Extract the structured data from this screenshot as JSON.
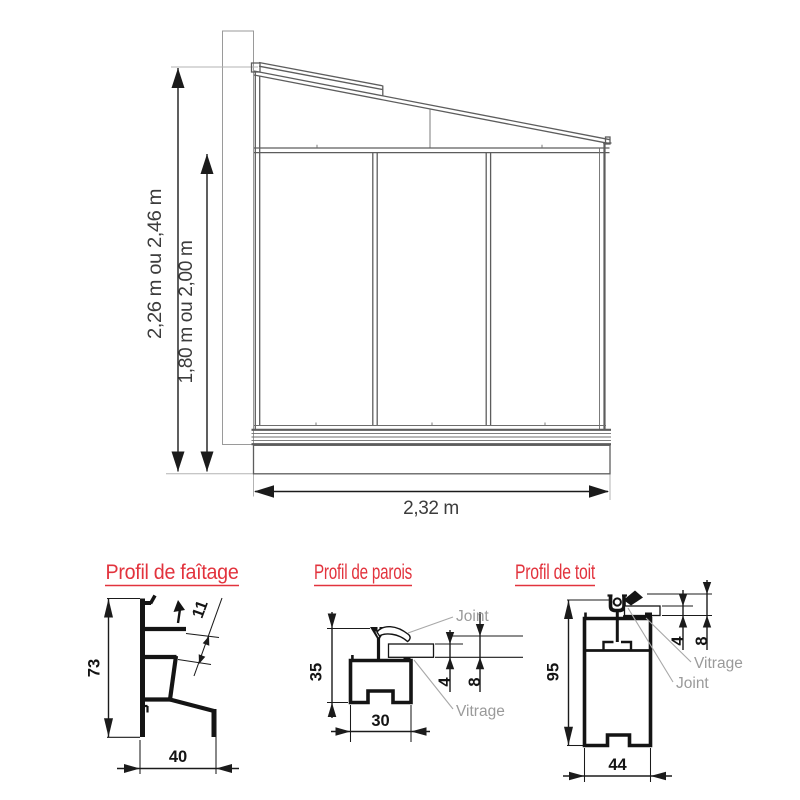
{
  "elevation": {
    "height_total_label": "2,26 m ou 2,46 m",
    "height_wall_label": "1,80 m ou 2,00 m",
    "width_label": "2,32 m"
  },
  "profiles": {
    "faitage": {
      "title": "Profil de faîtage",
      "height_mm": "73",
      "width_mm": "40",
      "glazing_mm": "11"
    },
    "parois": {
      "title": "Profil de parois",
      "height_mm": "35",
      "width_mm": "30",
      "glass_mm": "4",
      "glass_joint_mm": "8",
      "joint_label": "Joint",
      "vitrage_label": "Vitrage"
    },
    "toit": {
      "title": "Profil de toit",
      "height_mm": "95",
      "width_mm": "44",
      "glass_mm": "4",
      "glass_joint_mm": "8",
      "joint_label": "Joint",
      "vitrage_label": "Vitrage"
    }
  },
  "colors": {
    "accent_red": "#e2333d",
    "dimension_black": "#1b1b1b",
    "structure_gray": "#5d5d5d",
    "label_gray": "#9a9a9a"
  }
}
